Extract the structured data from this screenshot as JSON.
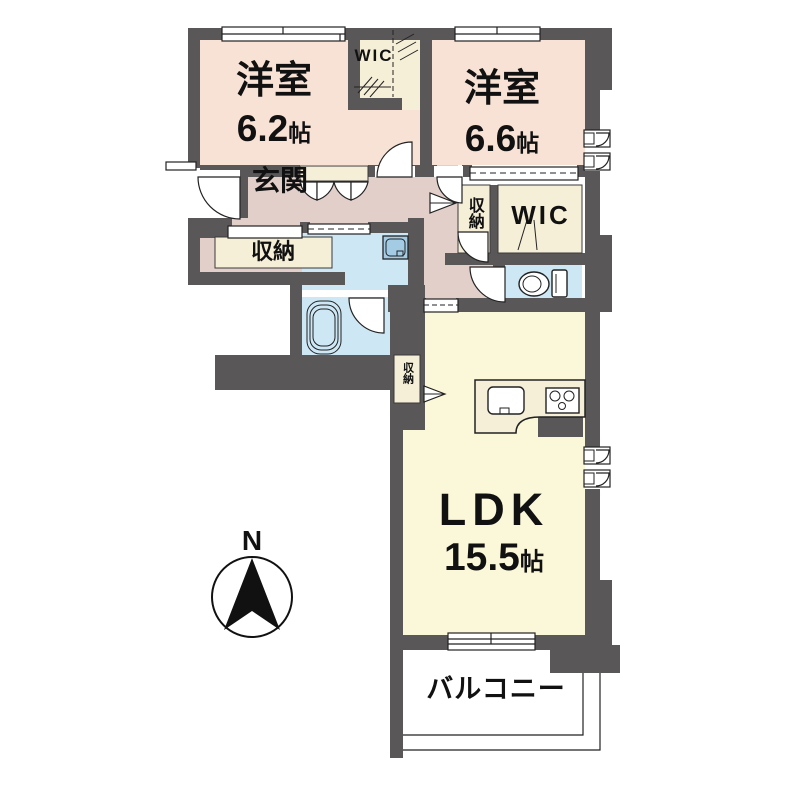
{
  "colors": {
    "wall": "#595757",
    "room_salmon": "#f8e2d5",
    "room_cream": "#f5efd8",
    "room_yellow": "#faf8d8",
    "hall_mauve": "#e2cfc9",
    "water_blue": "#cde7f5",
    "fixture_blue": "#a3cbe4",
    "line": "#222222",
    "text": "#111111"
  },
  "rooms": {
    "bedroom1": {
      "name": "洋室",
      "size": "6.2",
      "unit": "帖"
    },
    "bedroom2": {
      "name": "洋室",
      "size": "6.6",
      "unit": "帖"
    },
    "ldk": {
      "name": "LDK",
      "size": "15.5",
      "unit": "帖"
    },
    "entrance": {
      "name": "玄関"
    },
    "wic_north": {
      "name": "WIC"
    },
    "wic_east": {
      "name": "WIC"
    },
    "storage_entrance": {
      "name": "収納"
    },
    "storage_east": {
      "name": "収納"
    },
    "storage_ldk": {
      "name": "収納"
    },
    "balcony": {
      "name": "バルコニー"
    },
    "compass": {
      "label": "N"
    }
  }
}
